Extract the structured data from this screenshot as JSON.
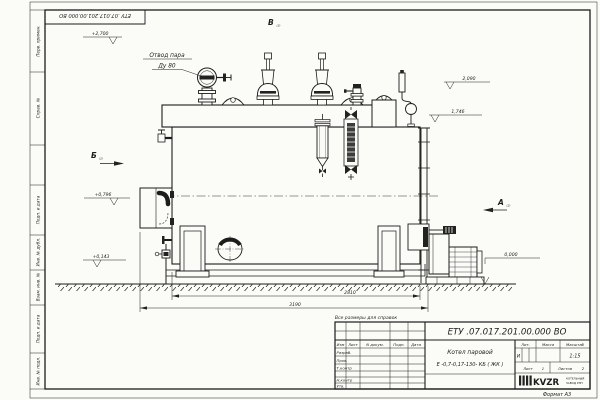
{
  "sheet": {
    "format_label": "Формат А3",
    "margin_labels_top": [
      "Перв. примен.",
      "Справ. №"
    ],
    "margin_labels_bottom": [
      "Подп. и дата",
      "Инв. № дубл.",
      "Взам. инв. №",
      "Подп. и дата",
      "Инв. № подл."
    ]
  },
  "drawing": {
    "note": "Все размеры для справок",
    "labels": {
      "steam_outlet_line1": "Отвод пара",
      "steam_outlet_line2": "Ду 80"
    },
    "views": {
      "a": "А",
      "b": "Б",
      "v": "В",
      "sheet_ref": "(2)"
    },
    "elevations": {
      "top": "+2,700",
      "gauge": "2,090",
      "box": "1,746",
      "burner": "+0,796",
      "drain": "+0,143",
      "ground": "0,000"
    },
    "dimensions": {
      "body_length": "2810",
      "overall_length": "3190"
    }
  },
  "title_block": {
    "doc_number": "ЕТУ .07.017.201.00.000  ВО",
    "product_line1": "Котел паровой",
    "product_line2": "Е -0,7-0,17-130- КБ ( ЖК )",
    "col_izm": "Изм",
    "col_list": "Лист",
    "col_docum": "N докум.",
    "col_podp": "Подп.",
    "col_data": "Дата",
    "row_razrab": "Разраб.",
    "row_prov": "Пров.",
    "row_tkontr": "Т.контр",
    "row_nkontr": "Н.контр",
    "row_utv": "Утв.",
    "lit_label": "Лит.",
    "lit_value": "И",
    "mass_label": "Масса",
    "scale_label": "Масштаб",
    "scale_value": "1:15",
    "sheet_label": "Лист",
    "sheet_value": "1",
    "sheets_label": "Листов",
    "sheets_value": "2",
    "logo": "KVZR",
    "logo_sub1": "КОТЕЛЬНЫЙ",
    "logo_sub2": "ЗАВОД РЭП"
  },
  "colors": {
    "paper": "#fbfbf8",
    "ink": "#1c1c1a"
  }
}
